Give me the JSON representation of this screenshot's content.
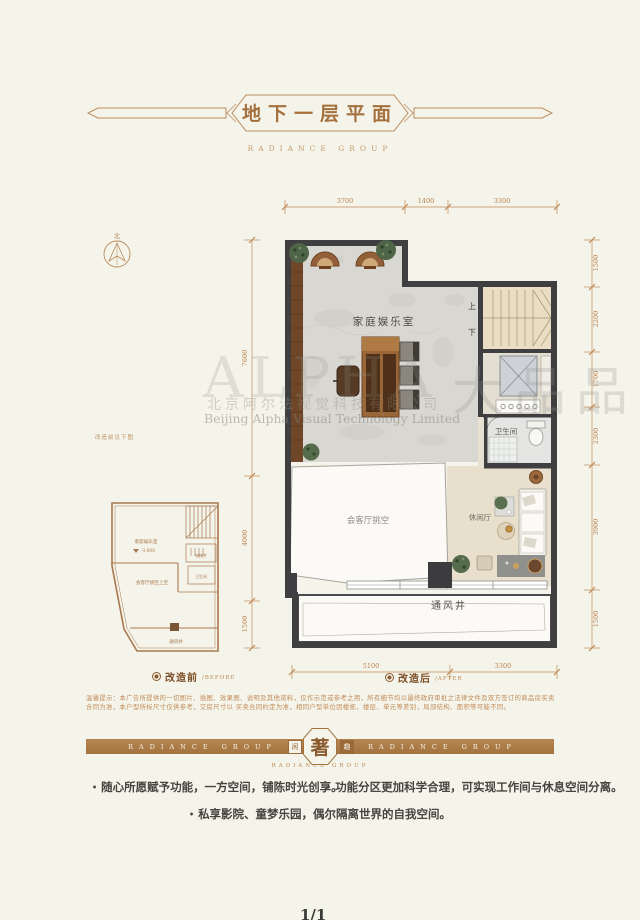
{
  "header": {
    "title": "地下一层平面",
    "subtitle": "RADIANCE GROUP"
  },
  "compass": {
    "north_label": "北"
  },
  "note": "改造前见下图",
  "plan_after": {
    "caption": {
      "name": "改造后",
      "tag": "/AFTER"
    },
    "rooms": {
      "family_room": "家庭娱乐室",
      "stairs_up": "上",
      "stairs_down": "下",
      "bathroom": "卫生间",
      "void": "会客厅挑空",
      "lounge": "休闲厅",
      "vent": "通风井"
    },
    "dims": {
      "top": [
        "3700",
        "1400",
        "3300"
      ],
      "right": [
        "1500",
        "2200",
        "1700",
        "2300",
        "3900",
        "1500"
      ],
      "left": [
        "7600",
        "4000",
        "1500"
      ],
      "bottom": [
        "5100",
        "3300"
      ]
    }
  },
  "plan_before": {
    "caption": {
      "name": "改造前",
      "tag": "/BEFORE"
    },
    "rooms": {
      "family_room": "家庭娱乐室",
      "elevation": "-3.000",
      "void": "会客厅挑空上空",
      "elevator": "电梯井",
      "bathroom": "卫生间",
      "vent": "通风井"
    }
  },
  "disclaimer": {
    "line1": "温馨提示：本广告所提供的一切图片、插图、效果图、说明及其他资料，仅作示范或参考之用，所有细节均以最终政府审批之法律文件及双方签订的商品房买卖合同为准，本户型所标尺寸仅供参考，交房尺寸以",
    "line2": "买卖合同约定为准，相同户型单位因楼栋、楼层、单元等差别，局部结构、面积等可能不同。"
  },
  "banner": {
    "left": "RADIANCE GROUP",
    "right": "RADIANCE GROUP",
    "seal_left": "闲",
    "seal_center": "著",
    "seal_right": "趣",
    "sub": "RADIANCE GROUP"
  },
  "bullets": [
    "随心所愿赋予功能，一方空间，铺陈时光创享。",
    "功能分区更加科学合理，可实现工作间与休息空间分离。",
    "私享影院、童梦乐园，偶尔隔离世界的自我空间。"
  ],
  "watermark": {
    "brand": "ALPHA",
    "company_cn": "北京阿尔法视觉科技有限公司",
    "company_en": "Beijing Alpha Visual Technology Limited",
    "stamp": "大品品"
  },
  "page_marker": "1/1",
  "colors": {
    "accent": "#a4703d",
    "wall": "#404042",
    "cream": "#f5f4ea",
    "dim": "#c08a58"
  }
}
